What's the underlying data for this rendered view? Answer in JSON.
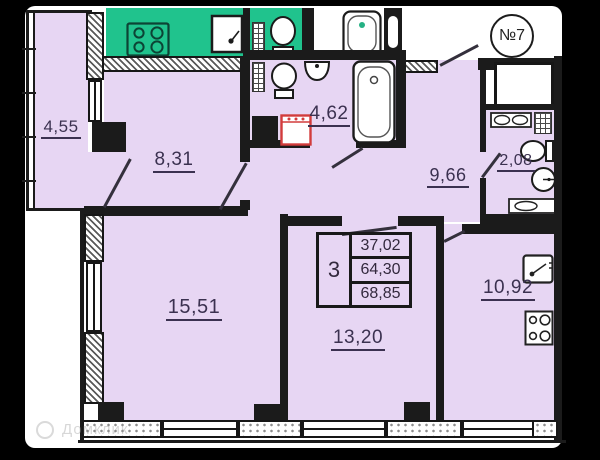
{
  "plan": {
    "unit_label": "№7",
    "rooms": [
      {
        "name": "loggia",
        "area": "4,55"
      },
      {
        "name": "room-1",
        "area": "8,31"
      },
      {
        "name": "bathroom",
        "area": "4,62"
      },
      {
        "name": "hallway",
        "area": "9,66"
      },
      {
        "name": "wc",
        "area": "2,08"
      },
      {
        "name": "room-2",
        "area": "15,51"
      },
      {
        "name": "room-3",
        "area": "13,20"
      },
      {
        "name": "kitchen-living",
        "area": "10,92"
      }
    ],
    "summary_table": {
      "rooms_count": "3",
      "areas": [
        "37,02",
        "64,30",
        "68,85"
      ]
    },
    "watermark": "Домклик",
    "colors": {
      "background": "#000000",
      "sheet": "#ffffff",
      "room_fill": "#e7d6f3",
      "neighbor_fill": "#20c38d",
      "wall": "#1b1b1b",
      "label_text": "#3b3150",
      "washer_accent": "#d23c3c"
    },
    "icons": {
      "stove-icon": "4-burner hob outline",
      "sink-icon": "square sink with tap",
      "toilet-icon": "toilet top view",
      "bathtub-icon": "bathtub top view",
      "washbasin-icon": "semicircle wall basin",
      "round-basin-icon": "round basin with tap",
      "washing-machine-icon": "red outlined square",
      "radiator-icon": "grid hatch block",
      "door-leaf-icon": "diagonal door swing line",
      "window-icon": "double line wall opening"
    }
  }
}
